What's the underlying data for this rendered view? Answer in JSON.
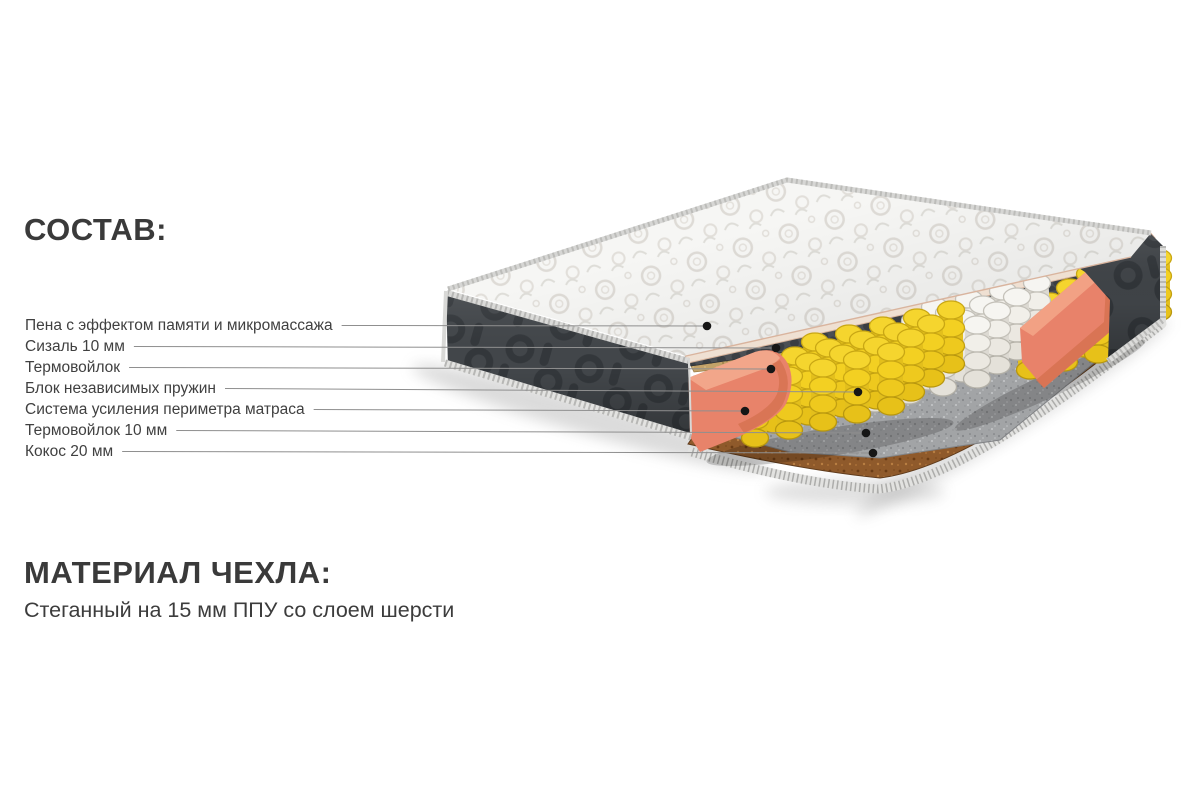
{
  "composition": {
    "title": "СОСТАВ:",
    "layers": [
      {
        "label": "Пена с эффектом памяти и микромассажа",
        "target": "memory-foam-layer"
      },
      {
        "label": "Сизаль 10 мм",
        "target": "sisal-layer"
      },
      {
        "label": "Термовойлок",
        "target": "thermo-felt-layer"
      },
      {
        "label": "Блок независимых пружин",
        "target": "pocket-spring-block"
      },
      {
        "label": "Система усиления периметра матраса",
        "target": "perimeter-reinforcement-rail"
      },
      {
        "label": "Термовойлок 10 мм",
        "target": "thermo-felt-bottom-layer"
      },
      {
        "label": "Кокос 20 мм",
        "target": "coconut-coir-layer"
      }
    ]
  },
  "cover": {
    "title": "МАТЕРИАЛ ЧЕХЛА:",
    "description": "Стеганный на 15 мм ППУ со слоем шерсти"
  },
  "diagram": {
    "alt": "3D-схема матраса в разрезе со слоями",
    "colors": {
      "accent_coral": "#e8836a",
      "spring_yellow": "#f3d22b",
      "spring_white": "#f0eee9",
      "foam_dark": "#42464a",
      "sisal_tan": "#c2a269",
      "felt_gray": "#a2a4a6",
      "coir_brown": "#8f5a2b",
      "quilt_white": "#f6f6f4",
      "text": "#3a3a3a",
      "leader_line": "#8f8f8f"
    }
  }
}
